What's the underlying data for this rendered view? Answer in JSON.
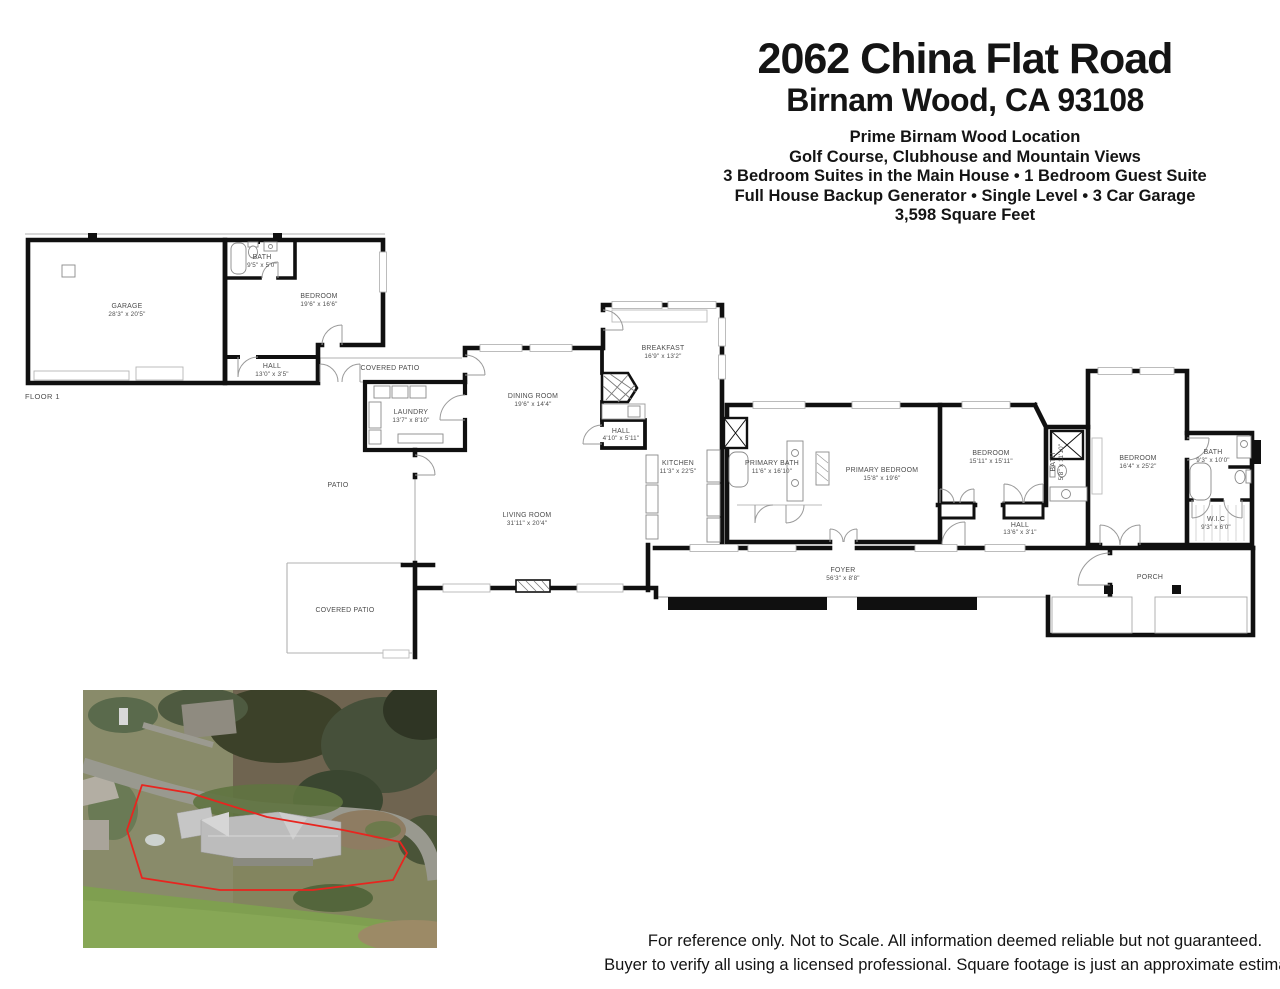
{
  "header": {
    "address_line1": "2062 China Flat Road",
    "address_line2": "Birnam Wood, CA 93108",
    "features": [
      "Prime Birnam Wood Location",
      "Golf Course, Clubhouse and Mountain Views",
      "3 Bedroom Suites in the Main House • 1 Bedroom Guest Suite",
      "Full House Backup Generator • Single Level • 3 Car Garage",
      "3,598 Square Feet"
    ]
  },
  "floor_label": "FLOOR 1",
  "rooms": [
    {
      "name": "GARAGE",
      "dims": "28'3\" x 20'5\""
    },
    {
      "name": "BATH",
      "dims": "9'5\" x 5'0\""
    },
    {
      "name": "BEDROOM",
      "dims": "19'6\" x 16'6\""
    },
    {
      "name": "HALL",
      "dims": "13'0\" x 3'5\""
    },
    {
      "name": "COVERED PATIO",
      "dims": ""
    },
    {
      "name": "LAUNDRY",
      "dims": "13'7\" x 8'10\""
    },
    {
      "name": "DINING ROOM",
      "dims": "19'6\" x 14'4\""
    },
    {
      "name": "BREAKFAST",
      "dims": "16'9\" x 13'2\""
    },
    {
      "name": "HALL",
      "dims": "4'10\" x 5'11\""
    },
    {
      "name": "KITCHEN",
      "dims": "11'3\" x 22'5\""
    },
    {
      "name": "PATIO",
      "dims": ""
    },
    {
      "name": "LIVING ROOM",
      "dims": "31'11\" x 20'4\""
    },
    {
      "name": "COVERED PATIO",
      "dims": ""
    },
    {
      "name": "PRIMARY BATH",
      "dims": "11'6\" x 16'10\""
    },
    {
      "name": "PRIMARY BEDROOM",
      "dims": "15'8\" x 19'6\""
    },
    {
      "name": "BEDROOM",
      "dims": "15'11\" x 15'11\""
    },
    {
      "name": "BATH",
      "dims": "5'8\" x 11'10\""
    },
    {
      "name": "HALL",
      "dims": "13'6\" x 3'1\""
    },
    {
      "name": "BEDROOM",
      "dims": "16'4\" x 25'2\""
    },
    {
      "name": "BATH",
      "dims": "9'3\" x 10'0\""
    },
    {
      "name": "W.I.C",
      "dims": "9'3\" x 6'0\""
    },
    {
      "name": "FOYER",
      "dims": "56'3\" x 8'8\""
    },
    {
      "name": "PORCH",
      "dims": ""
    }
  ],
  "footer": {
    "line1": "For reference only. Not to Scale.  All information deemed reliable but not guaranteed.",
    "line2": "Buyer to verify all using a licensed professional. Square footage is just an approximate estimate.",
    "line3": "."
  },
  "colors": {
    "wall": "#111111",
    "room_label": "#4d4d4d",
    "property_boundary_red": "#e8251f"
  }
}
